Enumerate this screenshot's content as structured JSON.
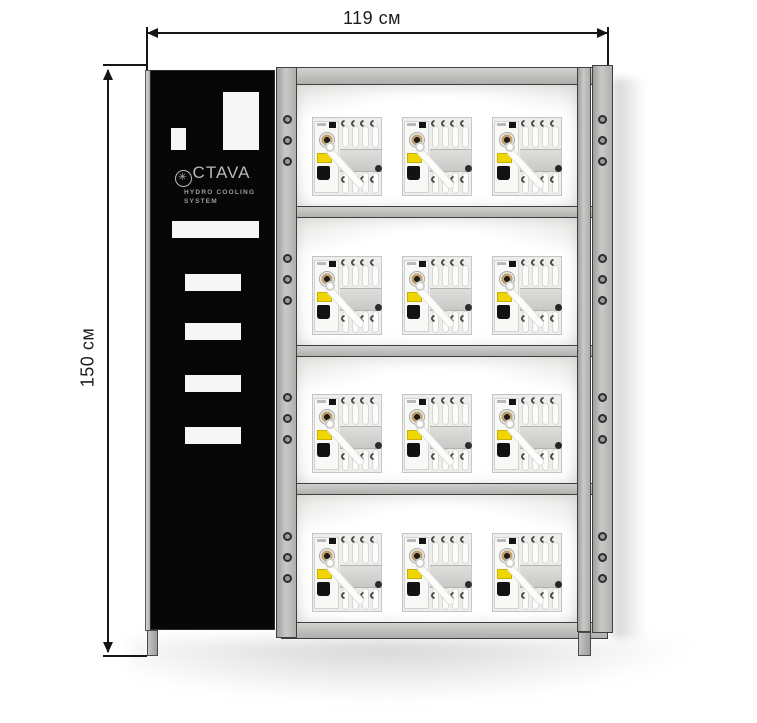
{
  "diagram": {
    "dimensions": {
      "width_label": "119 см",
      "height_label": "150 см"
    },
    "panel": {
      "brand_icon_glyph": "✳",
      "brand_text": "CTAVA",
      "subtitle_line1": "HYDRO COOLING",
      "subtitle_line2": "SYSTEM"
    },
    "rack": {
      "shelf_count": 4,
      "units_per_shelf": 3,
      "holes_per_section": 3
    },
    "colors": {
      "frame_gray": "#b7b7b5",
      "panel_black": "#070707",
      "cutout_white": "#f6f6f6",
      "unit_label_yellow": "#f0d600",
      "dial_ring_bronze": "#c2a06c",
      "dimension_line": "#161616"
    }
  }
}
